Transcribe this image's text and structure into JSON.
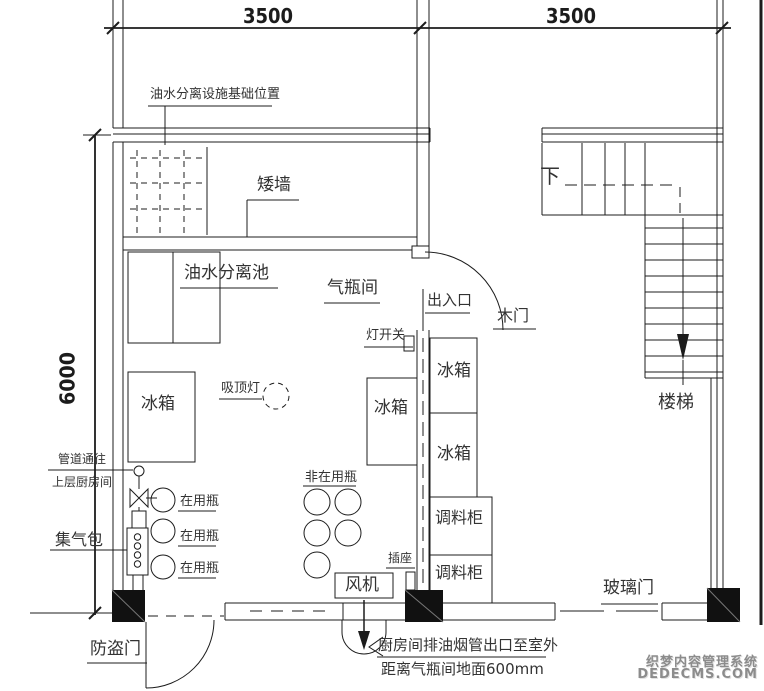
{
  "dimensions": {
    "top_span_left": "3500",
    "top_span_right": "3500",
    "left_height": "6000"
  },
  "labels": {
    "base_note": "油水分离设施基础位置",
    "low_wall": "矮墙",
    "oil_water_pool": "油水分离池",
    "gas_cylinder_room": "气瓶间",
    "entrance": "出入口",
    "wooden_door": "木门",
    "light_switch": "灯开关",
    "ceiling_lamp": "吸顶灯",
    "fridge": "冰箱",
    "seasoning_cabinet": "调料柜",
    "pipe_note_line1": "管道通往",
    "pipe_note_line2": "上层厨房间",
    "gas_collector": "集气包",
    "in_use_bottle": "在用瓶",
    "not_in_use_bottle": "非在用瓶",
    "socket": "插座",
    "fan": "风机",
    "security_door": "防盗门",
    "glass_door": "玻璃门",
    "stairs": "楼梯",
    "down": "下",
    "exhaust_note_line1": "厨房间排油烟管出口至室外",
    "exhaust_note_line2": "距离气瓶间地面600mm"
  },
  "watermark": {
    "line1": "织梦内容管理系统",
    "line2": "DEDECMS.COM"
  },
  "colors": {
    "line": "#1c1c1c",
    "text": "#333333",
    "watermark": "#8c8c8c",
    "background": "#ffffff"
  }
}
